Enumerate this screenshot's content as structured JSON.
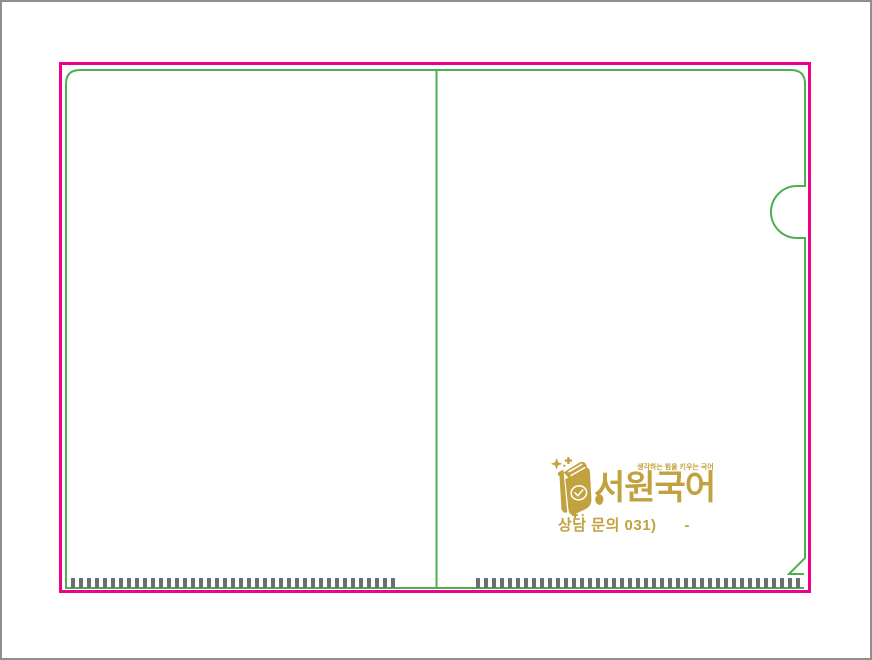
{
  "colors": {
    "cut_line": "#EC008C",
    "fold_outline": "#4CB050",
    "hatch_marks": "#6D6E71",
    "logo_gold": "#C2A23E",
    "frame_border": "#8F8F8F"
  },
  "logo": {
    "icon": "book-with-sparkles-icon",
    "tagline": "생각하는 힘을 키우는 국어",
    "brand": "서원국어",
    "contact": "상담 문의 031)      -"
  }
}
